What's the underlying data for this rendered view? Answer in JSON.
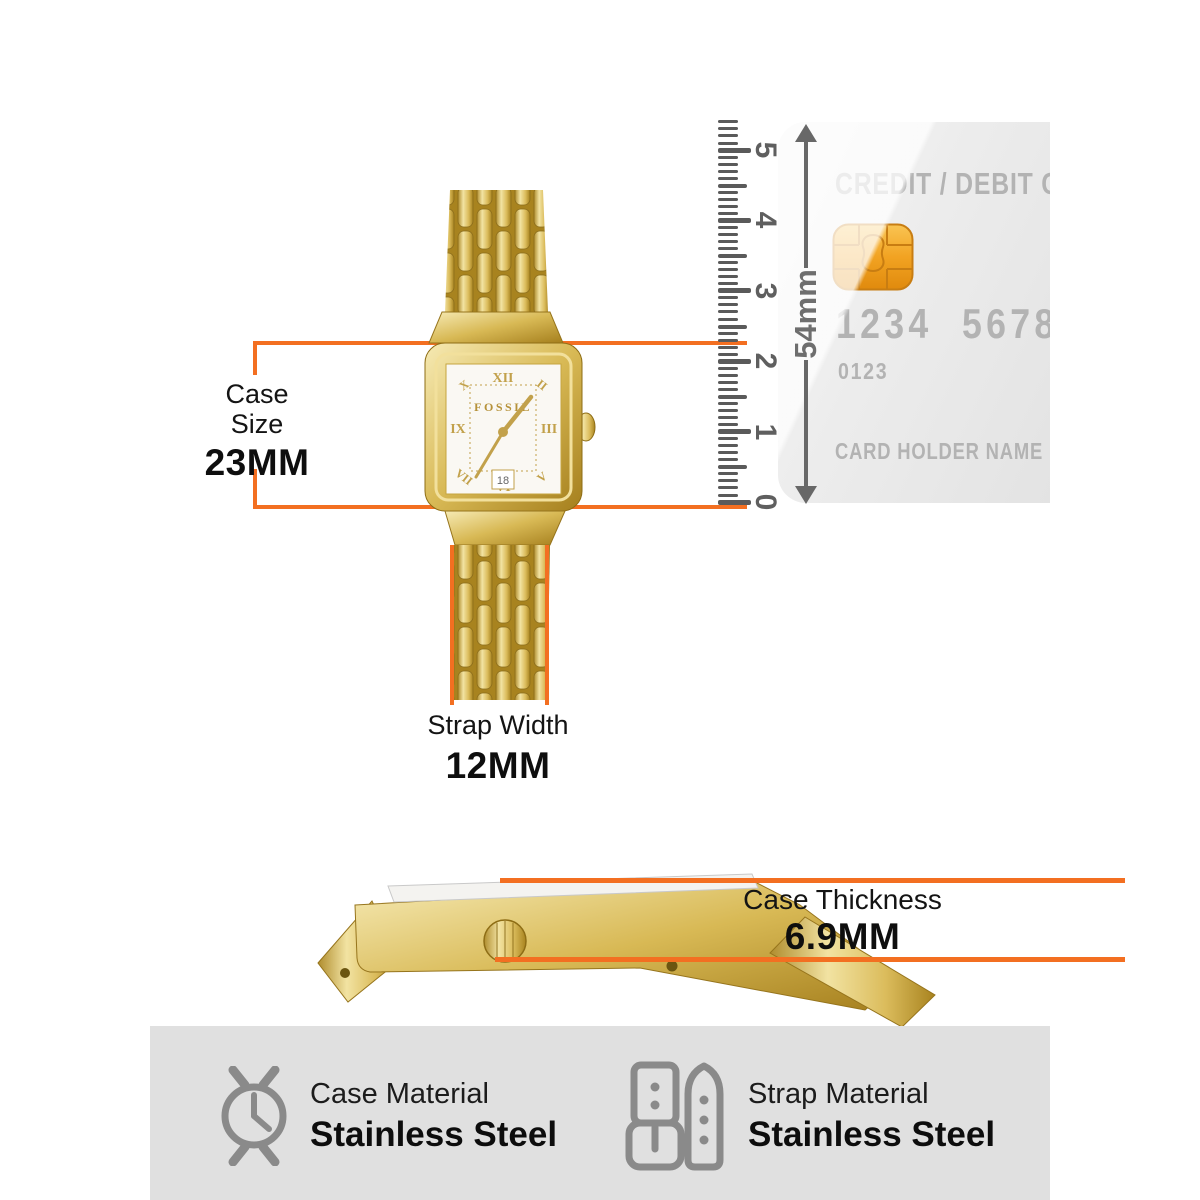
{
  "accent_orange": "#F36F21",
  "gold": "#D4AF4E",
  "panel_gray": "#E0E0E0",
  "watch": {
    "brand": "FOSSIL",
    "date": "18",
    "numerals": {
      "top": "XII",
      "right": "III",
      "bottom": "VI",
      "left": "IX",
      "top_left": "X",
      "top_right": "II",
      "bottom_left": "VII",
      "bottom_right": "V"
    }
  },
  "annotations": {
    "case_size": {
      "line1": "Case",
      "line2": "Size",
      "value": "23MM"
    },
    "strap_width": {
      "label": "Strap Width",
      "value": "12MM"
    },
    "case_thickness": {
      "label": "Case Thickness",
      "value": "6.9MM"
    }
  },
  "ruler": {
    "unit_labels": [
      "0",
      "1",
      "2",
      "3",
      "4",
      "5"
    ],
    "mm_per_unit": 10,
    "extra_mm_above": 4,
    "arrow_label": "54mm"
  },
  "card": {
    "title": "CREDIT / DEBIT CARD",
    "number_left": "1234",
    "number_right": "5678",
    "small_number": "0123",
    "holder": "CARD HOLDER NAME"
  },
  "materials": [
    {
      "icon": "watch-case-icon",
      "label": "Case Material",
      "value": "Stainless Steel"
    },
    {
      "icon": "strap-icon",
      "label": "Strap Material",
      "value": "Stainless Steel"
    }
  ]
}
